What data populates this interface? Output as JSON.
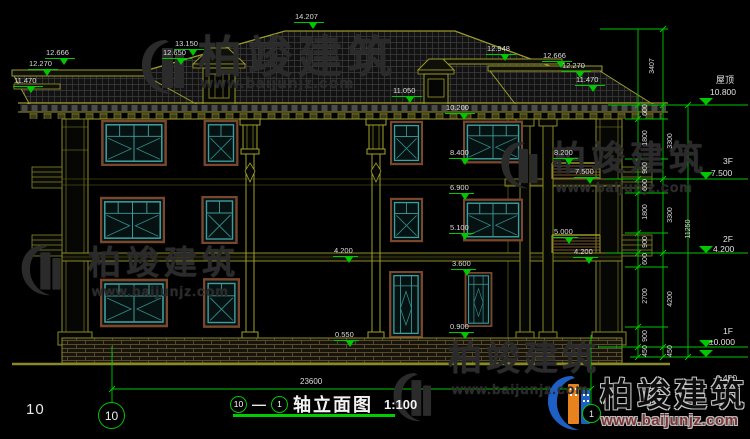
{
  "drawing": {
    "title": {
      "axis_start": "10",
      "axis_end": "1",
      "name": "轴立面图",
      "scale": "1:100"
    },
    "sheet_number": "10",
    "bottom_width_dim": "23600"
  },
  "top_marks": [
    "12.666",
    "12.270",
    "11.470",
    "13.150",
    "12.650",
    "14.207",
    "12.948",
    "12.666",
    "12.270",
    "11.470",
    "11.050",
    "10.200"
  ],
  "facade_marks": [
    "8.400",
    "6.900",
    "5.100",
    "3.600",
    "0.900",
    "4.200",
    "0.550",
    "8.200",
    "7.500",
    "5.000",
    "4.200"
  ],
  "chain_inner": [
    "600",
    "1800",
    "900",
    "600",
    "1800",
    "900",
    "600",
    "2700",
    "900",
    "450"
  ],
  "chain_outer": [
    "3407",
    "3300",
    "3300",
    "4200",
    "450"
  ],
  "chain_total": "11250",
  "levels": [
    {
      "name": "屋顶",
      "value": "10.800"
    },
    {
      "name": "3F",
      "value": "7.500"
    },
    {
      "name": "2F",
      "value": "4.200"
    },
    {
      "name": "1F",
      "value": "±0.000"
    },
    {
      "name": "",
      "value": "-0.450"
    }
  ],
  "watermark": {
    "brand": "柏竣建筑",
    "url": "www.baijunjz.com"
  },
  "colors": {
    "dim_green": "#00c800",
    "line_olive": "#9a9a2a",
    "window_teal": "#3f9d9d",
    "window_frame_brown": "#7a462c",
    "text_white": "#e6e6e6",
    "logo_blue": "#1d5fc4",
    "logo_orange": "#e8821e"
  }
}
